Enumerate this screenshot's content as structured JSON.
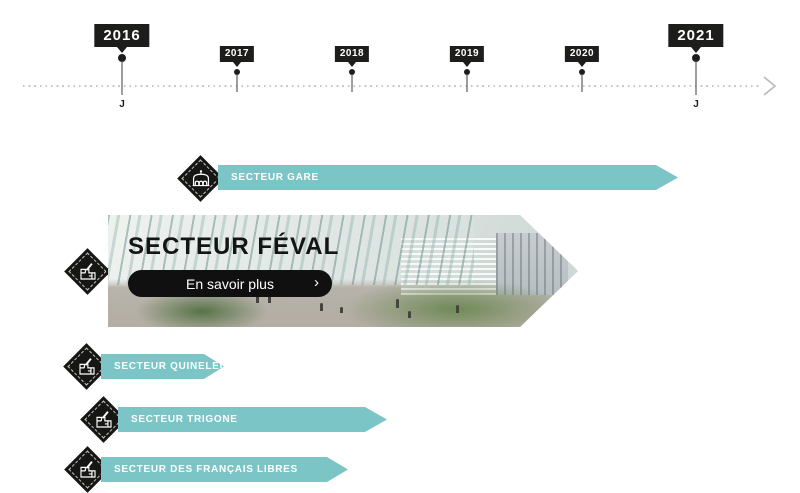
{
  "timeline": {
    "axis_style": "dotted",
    "arrow_icon": "chevron-right-icon",
    "years": [
      {
        "label": "2016",
        "emphasis": "major",
        "month": "J"
      },
      {
        "label": "2017",
        "emphasis": "minor"
      },
      {
        "label": "2018",
        "emphasis": "minor"
      },
      {
        "label": "2019",
        "emphasis": "minor"
      },
      {
        "label": "2020",
        "emphasis": "minor"
      },
      {
        "label": "2021",
        "emphasis": "major",
        "month": "J"
      }
    ]
  },
  "sectors": [
    {
      "label": "SECTEUR GARE",
      "icon": "station-icon",
      "state": "collapsed"
    },
    {
      "label": "SECTEUR FÉVAL",
      "icon": "map-plan-icon",
      "state": "expanded",
      "cta_label": "En savoir plus",
      "cta_chevron": "›"
    },
    {
      "label": "SECTEUR QUINELEU",
      "icon": "map-plan-icon",
      "state": "collapsed"
    },
    {
      "label": "SECTEUR TRIGONE",
      "icon": "map-plan-icon",
      "state": "collapsed"
    },
    {
      "label": "SECTEUR DES FRANÇAIS LIBRES",
      "icon": "map-plan-icon",
      "state": "collapsed"
    }
  ],
  "colors": {
    "teal": "#7cc5c6",
    "dark": "#1d1d1b",
    "axis_dot": "#c6c6c6",
    "cta_background": "#101010"
  }
}
